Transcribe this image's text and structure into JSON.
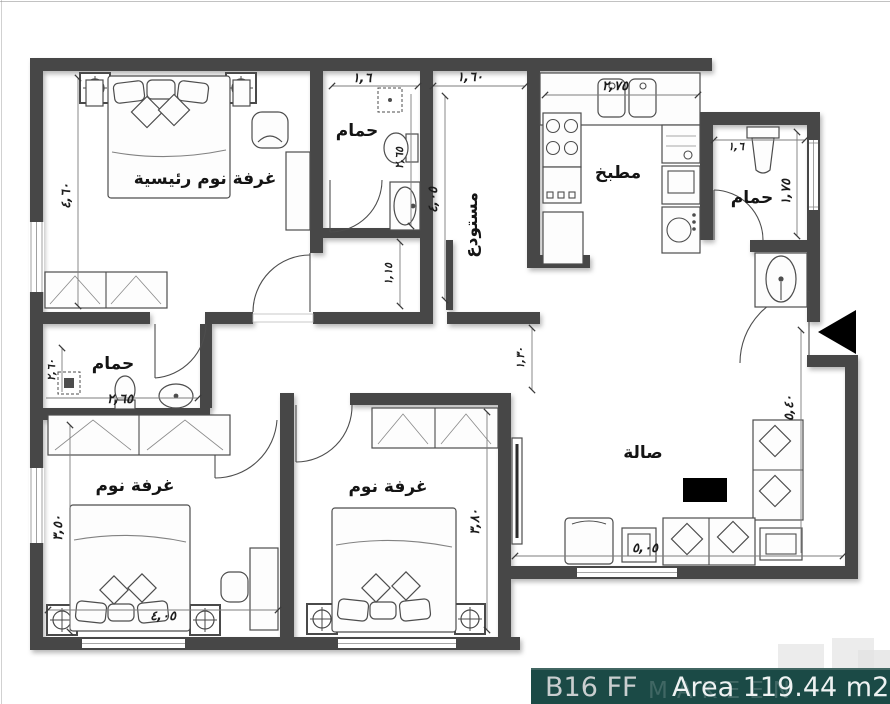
{
  "unit": {
    "code": "B16 FF",
    "area": "Area 119.44 m2"
  },
  "watermark": "MAKEEN",
  "colors": {
    "bar_bg": "#1b4a46",
    "wall": "#474747",
    "paper": "#ffffff",
    "entrance_arrow": "#000000"
  },
  "rooms": {
    "master": "غرفة نوم رئيسية",
    "bath_top": "حمام",
    "bath_right": "حمام",
    "bath_left": "حمام",
    "kitchen": "مطبخ",
    "storage": "مستودع",
    "living": "صالة",
    "bedroom_left": "غرفة نوم",
    "bedroom_mid": "غرفة نوم"
  },
  "dims": {
    "master_h": "٤,٦٠",
    "bath_top_w": "١,٦",
    "bath_top_h": "٢,٦٥",
    "storage_w": "١,٦٠",
    "storage_h": "٤,٠٥",
    "kitchen_w": "٢,٧٥",
    "hall_front_bath": "١,١٥",
    "hall_living": "١,٣٠",
    "bath_right_w": "١,٦",
    "bath_right_h": "١,٧٥",
    "bath_left_w": "٢,٦٥",
    "bath_left_h": "٢,٦٠",
    "bed_left_h": "٣,٥٠",
    "bed_left_w": "٤,٠٥",
    "bed_mid_h": "٣,٨٠",
    "living_w": "٥,٠٥",
    "living_h": "٥,٤٠"
  }
}
